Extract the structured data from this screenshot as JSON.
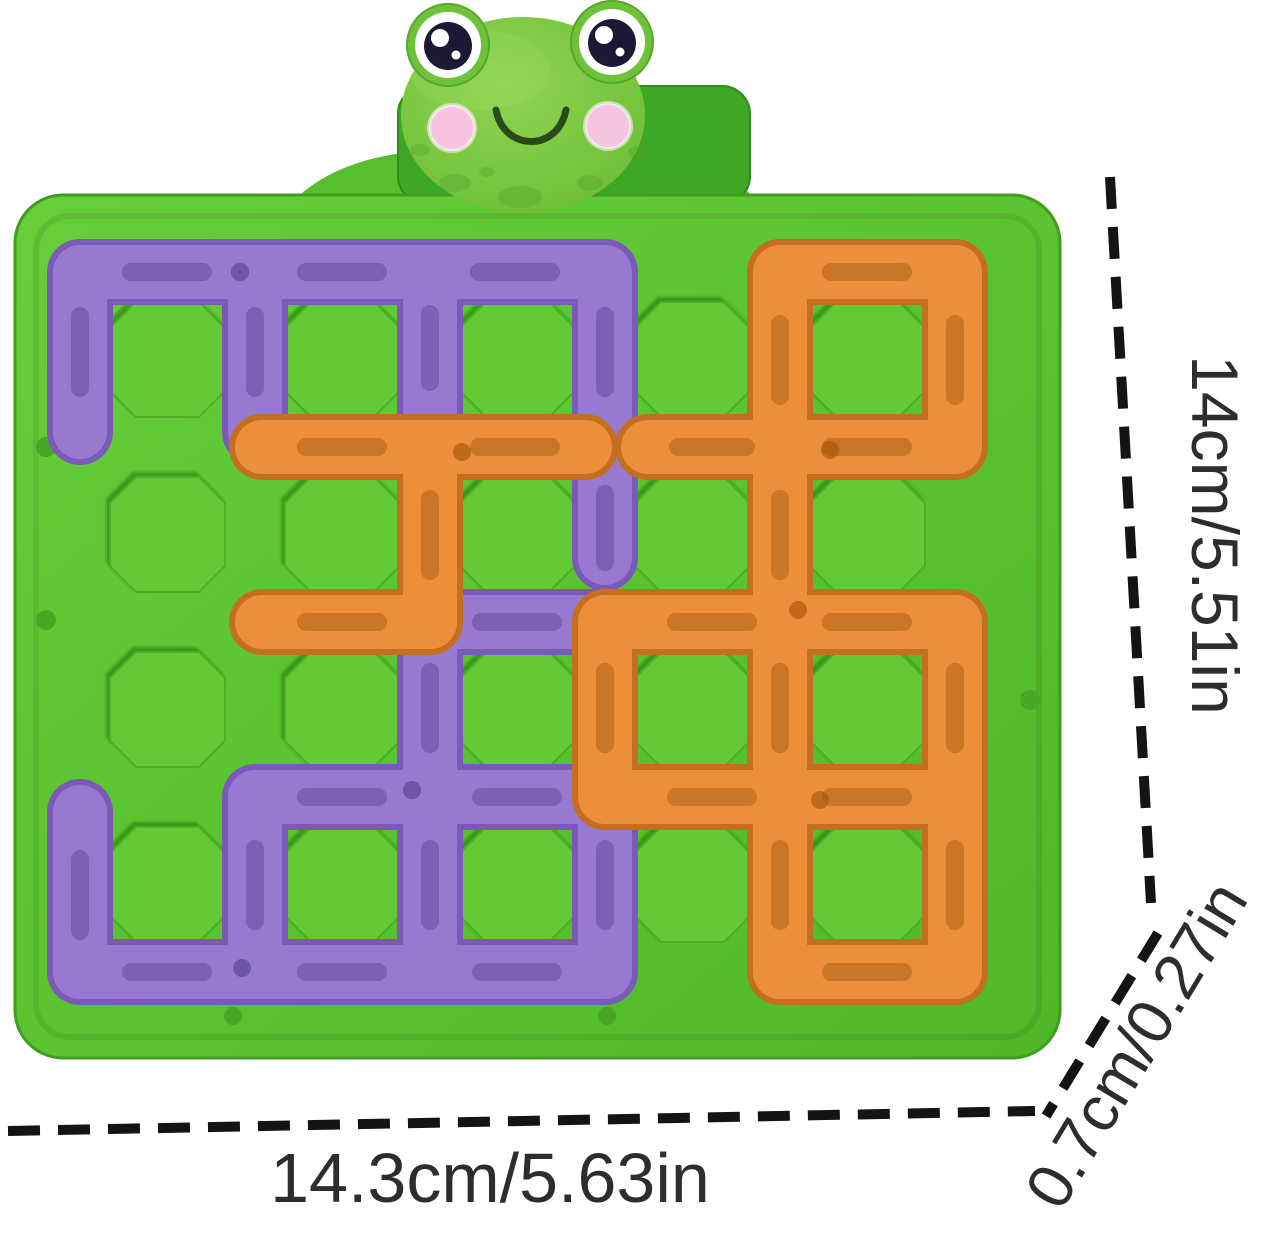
{
  "annotations": {
    "height_label": "14cm/5.51in",
    "width_label": "14.3cm/5.63in",
    "depth_label": "0.7cm/0.27in",
    "text_color": "#2d2d2d",
    "line_color": "#141414"
  },
  "board": {
    "grid_cols": 5,
    "grid_rows": 4,
    "color": "#58c22e",
    "cell_color": "#63ca35"
  },
  "pieces": {
    "purple_color": "#9879d2",
    "orange_color": "#ec8e3a"
  },
  "frog": {
    "face_color": "#7ec63e",
    "cheek_color": "#f6c3e0",
    "backboard_color": "#3ea726",
    "pupil_color": "#1d1833"
  }
}
